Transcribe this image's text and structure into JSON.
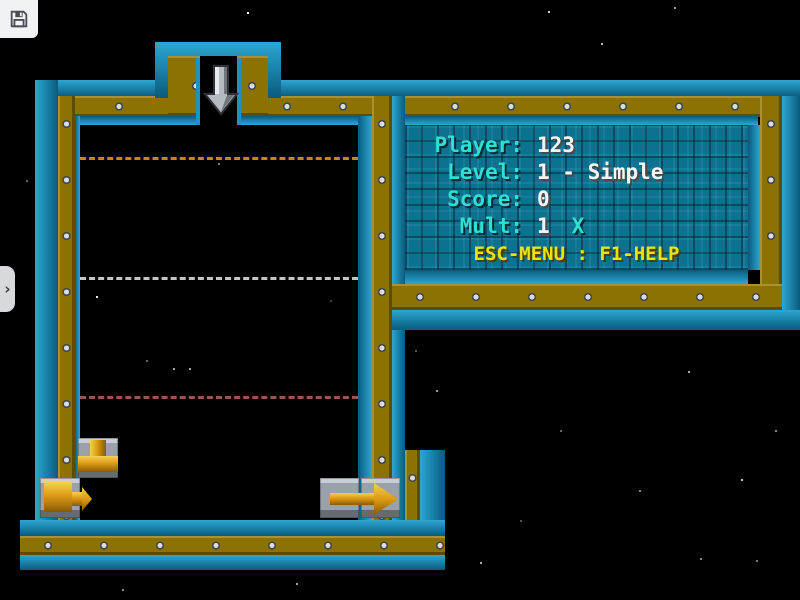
{
  "theme": {
    "bg": "#000000",
    "teal": "#1b86ae",
    "tealLight": "#2fa6d0",
    "tealDark": "#0b5a7c",
    "gold": "#8c7103",
    "panelBg": "#0d7190",
    "cyan": "#30dfd3",
    "white": "#f5f5f5",
    "yellow": "#e8e408",
    "guideYellow": "#c8860a",
    "guideWhite": "#c6c6c6",
    "guideRed": "#a35252",
    "pipeGold": "#dd9b15",
    "tileGray": "#9aa1a9"
  },
  "toolbar": {
    "save_icon": "floppy-disk"
  },
  "side_tab": {
    "chevron": "›"
  },
  "hud_panel": {
    "rows": [
      {
        "label": "Player:",
        "value": "123"
      },
      {
        "label": "Level:",
        "value": "1 - Simple"
      },
      {
        "label": "Score:",
        "value": "0"
      },
      {
        "label": "Mult:",
        "value": "1",
        "suffix": "X"
      }
    ],
    "footer": "ESC-MENU : F1-HELP"
  },
  "playfield": {
    "drop_arrow": "down-arrow",
    "guide_lines": [
      {
        "name": "upper",
        "color": "#c8860a"
      },
      {
        "name": "middle",
        "color": "#c6c6c6"
      },
      {
        "name": "lower",
        "color": "#a35252"
      }
    ],
    "pieces": [
      {
        "name": "t-junction-pipe"
      },
      {
        "name": "start-pipe-right"
      },
      {
        "name": "exit-arrow-right"
      }
    ]
  }
}
